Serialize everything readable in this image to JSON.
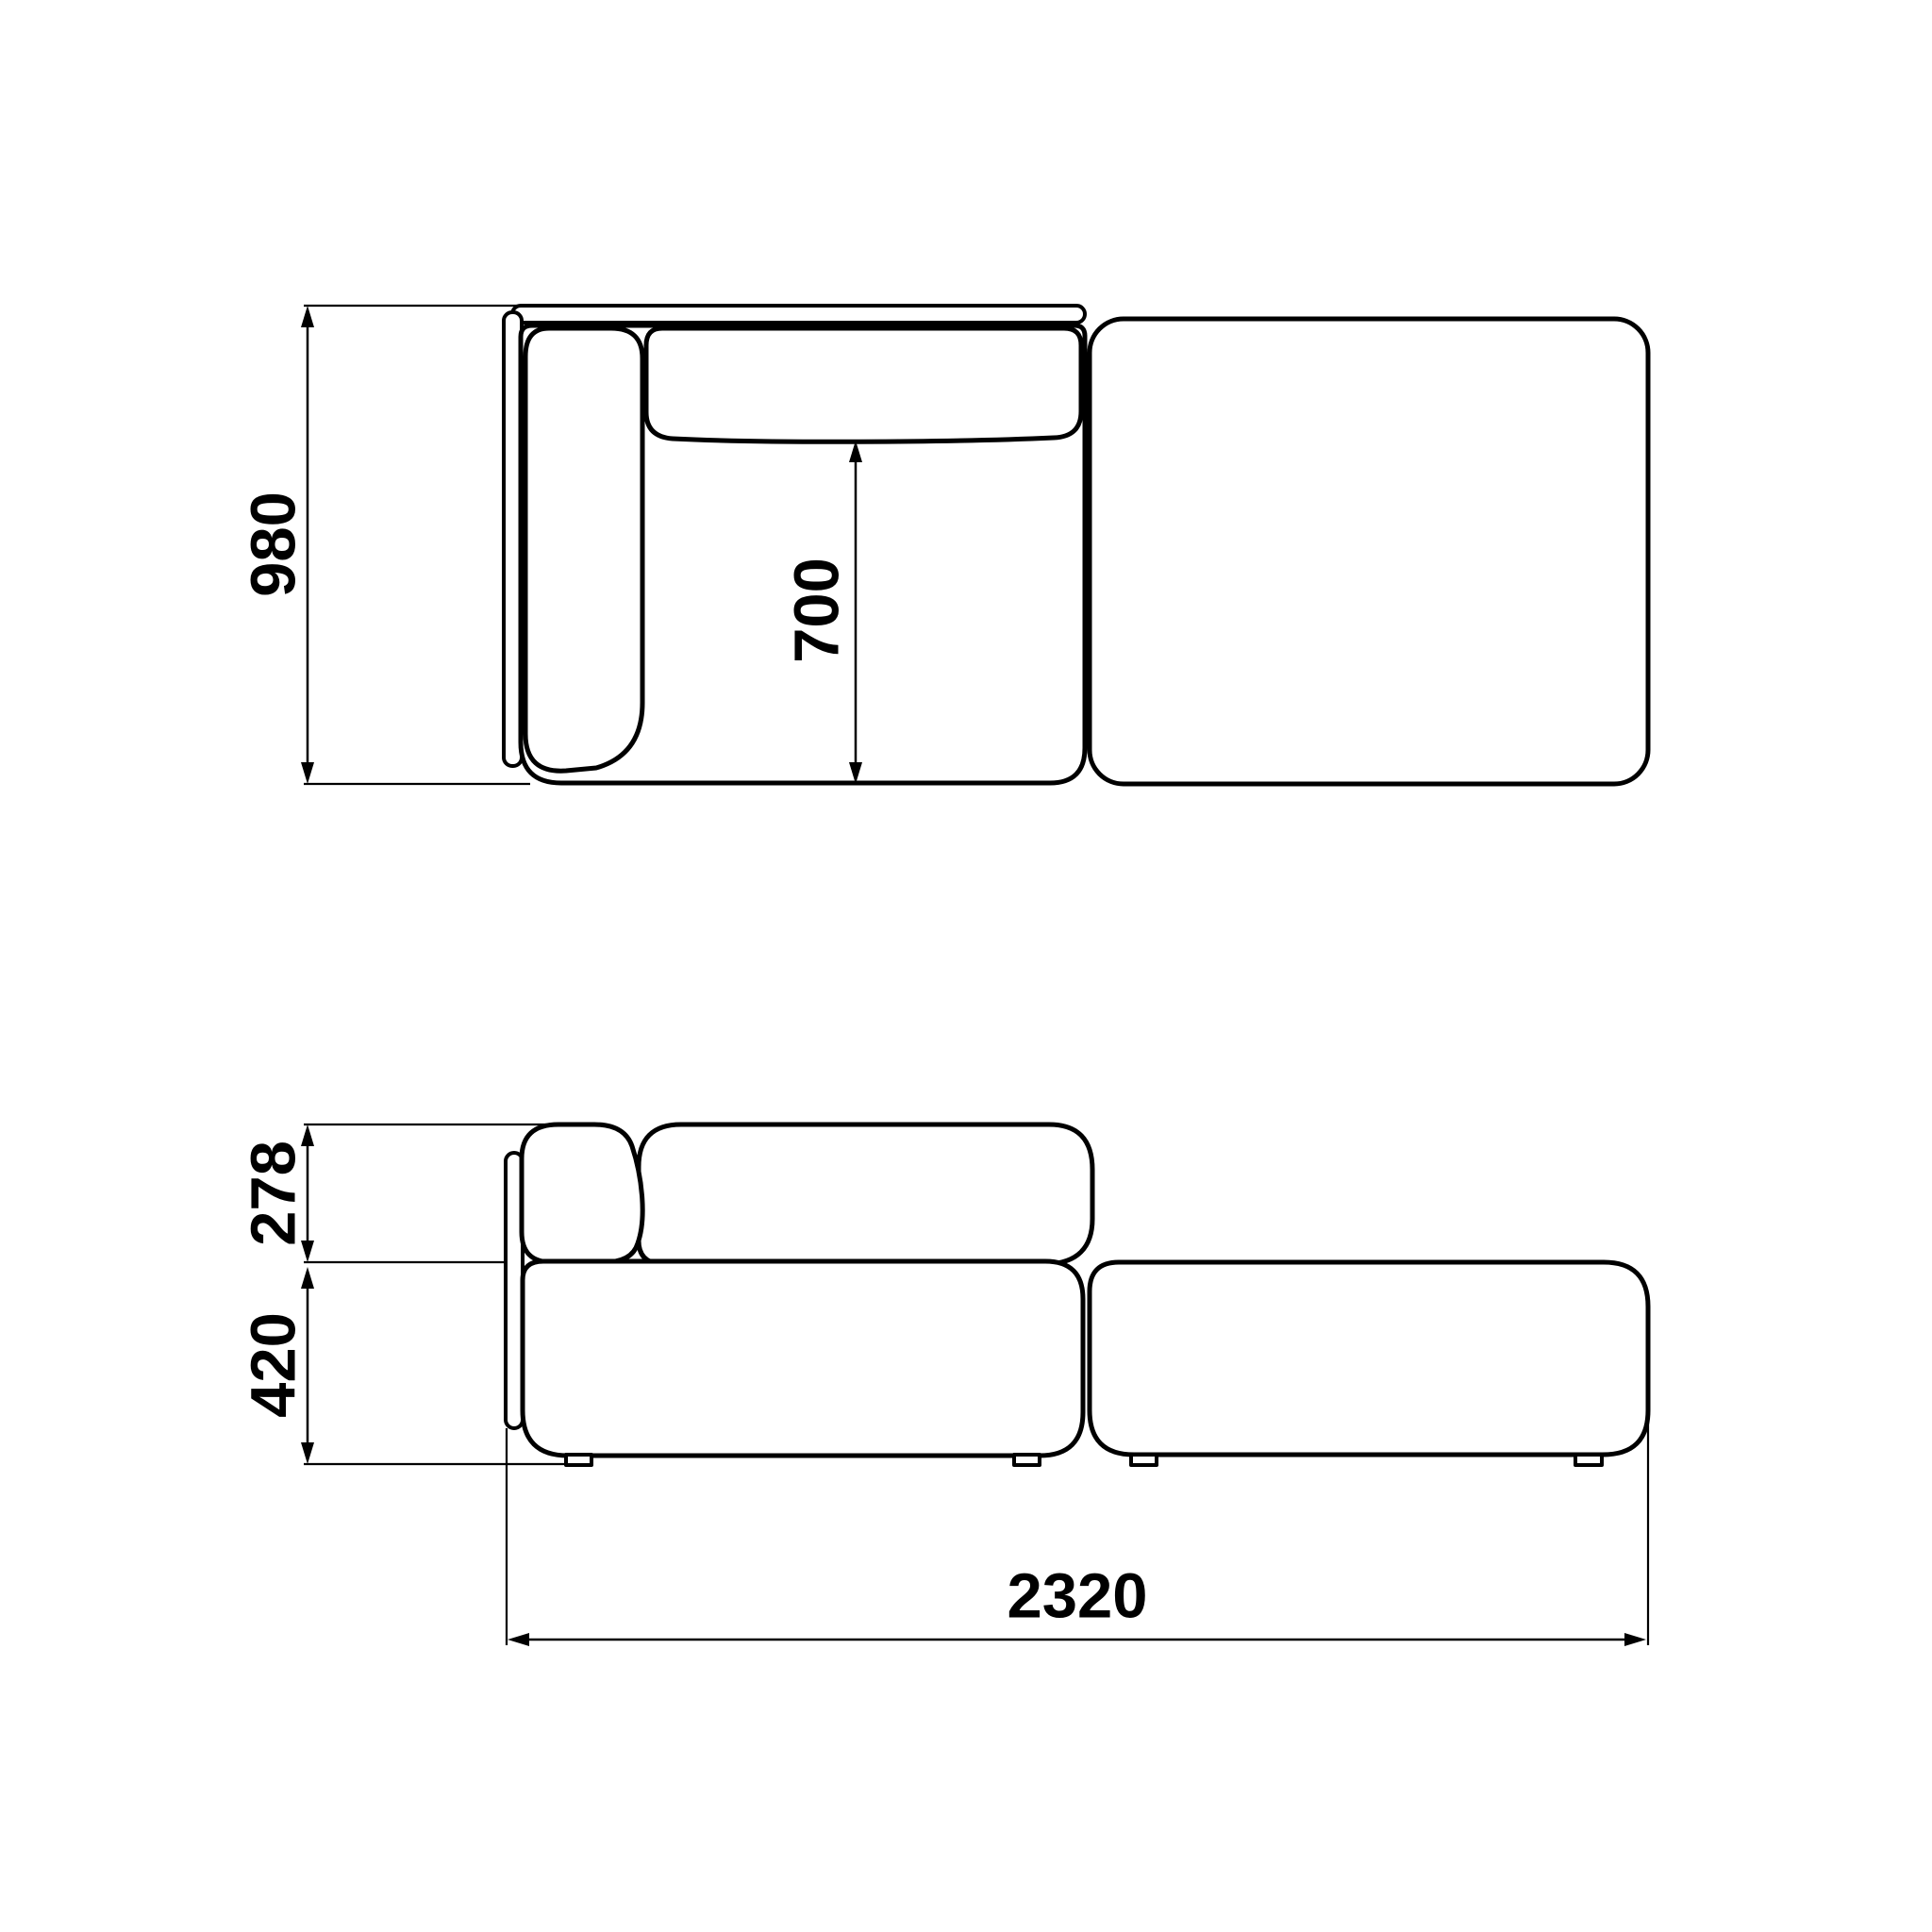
{
  "diagram": {
    "kind": "sofa-module-technical-drawing",
    "unit": "mm",
    "dimensions": {
      "overall_depth": "980",
      "seat_depth": "700",
      "backrest_height": "278",
      "seat_height": "420",
      "overall_length": "2320"
    }
  },
  "colors": {
    "line": "#000000",
    "background": "#ffffff"
  }
}
